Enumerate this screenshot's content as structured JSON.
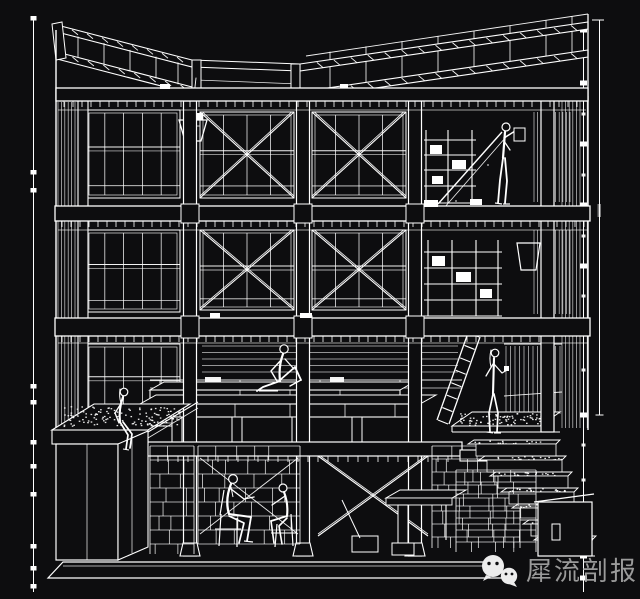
{
  "drawing": {
    "description": "White-on-black sectional perspective line drawing of a three-storey post-and-beam building with a butterfly roof, cross-braced window bays, a basement with seated figures, a planted roof box at left, wide stone steps at right, ladders, shelving and six human figures",
    "background_color": "#0d0d0f",
    "line_color": "#ffffff"
  },
  "dimensions": {
    "left_level_line": "vertical reference line with tick markers",
    "right_level_line": "vertical reference line with tick markers"
  },
  "watermark": {
    "text": "犀流剖报",
    "icon": "wechat-icon",
    "text_color": "#a6a6a6",
    "logo_color": "#ececec"
  }
}
